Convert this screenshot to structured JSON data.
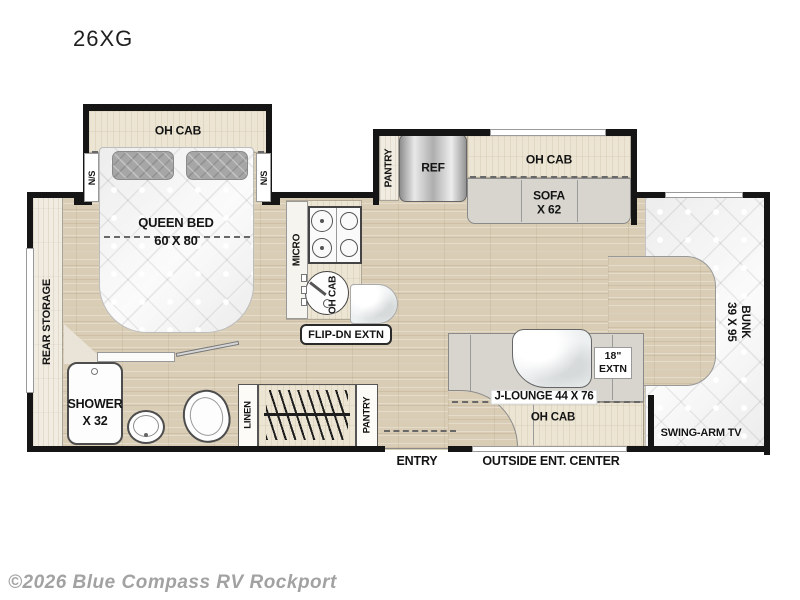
{
  "title": "26XG",
  "watermark": "©2026 Blue Compass RV Rockport",
  "colors": {
    "wall": "#151515",
    "floor_wood": "#d9cdb5",
    "cabinet_wood": "#ece5d3",
    "seat_gray": "#d7d5ce",
    "mattress": "#f2f2f2"
  },
  "labels": {
    "bedroom_oh_cab": "OH CAB",
    "ns_left": "N/S",
    "ns_right": "N/S",
    "queen_bed": "QUEEN BED",
    "queen_bed_size": "60 X 80",
    "rear_storage": "REAR STORAGE",
    "shower": "SHOWER",
    "shower_size": "X 32",
    "micro": "MICRO",
    "kitchen_oh_cab": "OH CAB",
    "flip_dn_extn": "FLIP-DN EXTN",
    "pantry_top": "PANTRY",
    "ref": "REF",
    "sofa_oh_cab": "OH CAB",
    "sofa": "SOFA",
    "sofa_size": "X 62",
    "bunk": "BUNK",
    "bunk_size": "39 X 95",
    "extn_size": "18\"",
    "extn": "EXTN",
    "j_lounge": "J-LOUNGE 44 X 76",
    "lounge_oh_cab": "OH CAB",
    "swing_arm_tv": "SWING-ARM TV",
    "linen": "LINEN",
    "pantry_bottom": "PANTRY",
    "entry": "ENTRY",
    "outside_ent_center": "OUTSIDE ENT. CENTER"
  }
}
